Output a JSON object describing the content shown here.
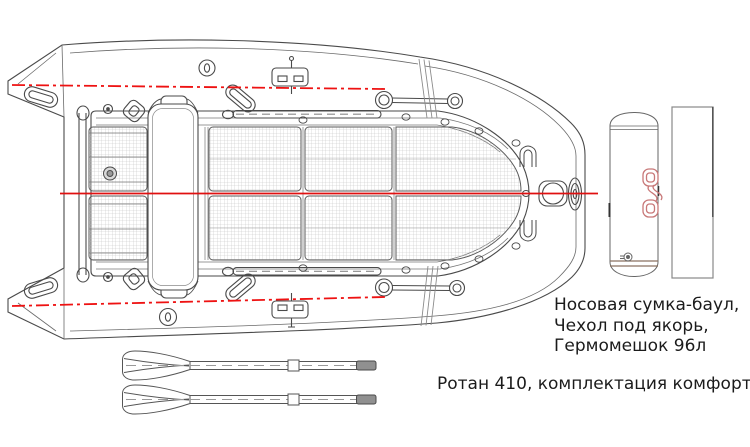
{
  "equipment_list": [
    "Носовая сумка-баул,",
    "Чехол под якорь,",
    "Гермомешок 96л"
  ],
  "caption": "Ротан 410, комплектация комфорт +",
  "colors": {
    "centerline_red": "#e01010",
    "tube_axis_red": "#ee1212",
    "drawing_line": "#4a4a4a",
    "floor_hatch": "#c4c4c4",
    "bag_handle_pink": "#c87878",
    "oar_grip_gray": "#909090"
  }
}
